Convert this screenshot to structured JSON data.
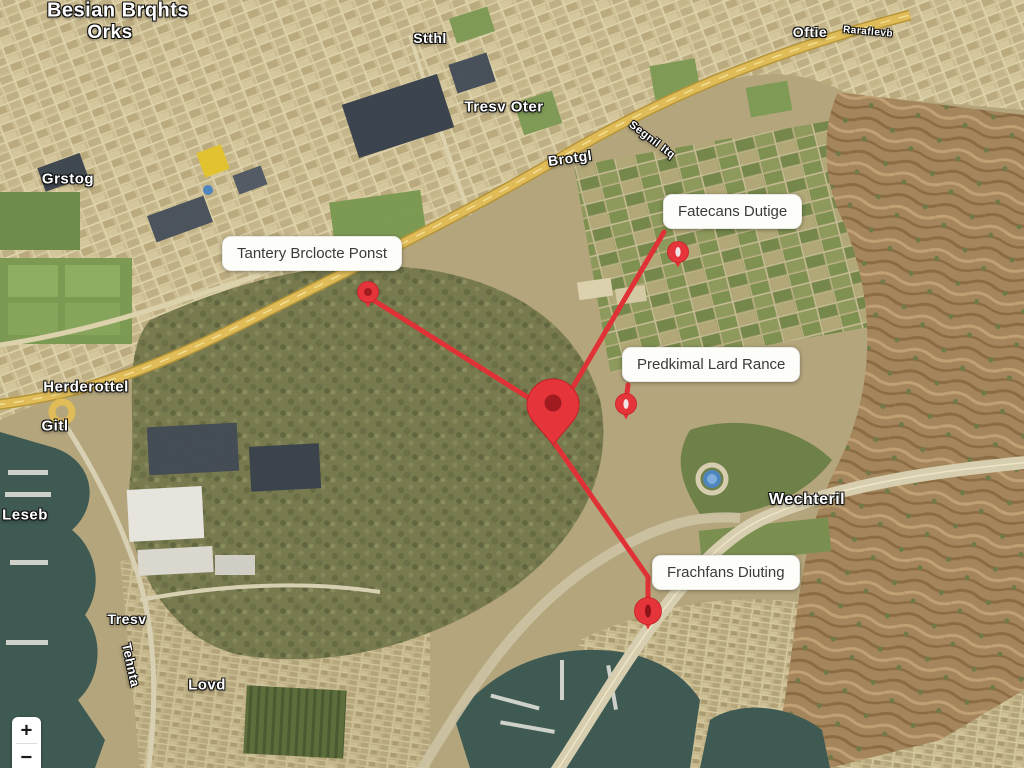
{
  "controls": {
    "zoom_in_label": "+",
    "zoom_out_label": "−"
  },
  "colors": {
    "route": "#e03236",
    "pin": "#e5343a",
    "pin_dark": "#a11b20",
    "pin_slot_light": "#f2e2e3",
    "pin_slot_dark": "#8c1418",
    "callout_bg": "#fdfdfa",
    "callout_text": "#3b3b3b",
    "highway_yellow": "#e2bd58",
    "water_teal": "#3d5952"
  },
  "callouts": [
    {
      "id": "callout-tantery",
      "text": "Tantery Brclocte Ponst",
      "x": 222,
      "y": 236
    },
    {
      "id": "callout-fatecans",
      "text": "Fatecans Dutige",
      "x": 663,
      "y": 194
    },
    {
      "id": "callout-predkimal",
      "text": "Predkimal Lard Rance",
      "x": 622,
      "y": 347
    },
    {
      "id": "callout-frachfans",
      "text": "Frachfans Diuting",
      "x": 652,
      "y": 555
    }
  ],
  "markers": [
    {
      "id": "map-pin-central",
      "style": "teardrop-large",
      "x": 553,
      "y": 445
    },
    {
      "id": "map-pin-tantery",
      "style": "dot",
      "x": 368,
      "y": 292
    },
    {
      "id": "map-pin-fatecans",
      "style": "slot",
      "x": 678,
      "y": 252
    },
    {
      "id": "map-pin-predkimal",
      "style": "slot",
      "x": 626,
      "y": 404
    },
    {
      "id": "map-pin-frachfans",
      "style": "slot-large",
      "x": 648,
      "y": 611
    }
  ],
  "routes": [
    {
      "id": "route-tantery-central",
      "points": [
        [
          370,
          298
        ],
        [
          548,
          410
        ]
      ]
    },
    {
      "id": "route-fatecans-central",
      "points": [
        [
          664,
          232
        ],
        [
          556,
          416
        ]
      ]
    },
    {
      "id": "route-predkimal-connector",
      "points": [
        [
          628,
          385
        ],
        [
          626,
          402
        ]
      ]
    },
    {
      "id": "route-central-frachfans",
      "points": [
        [
          553,
          441
        ],
        [
          648,
          577
        ],
        [
          648,
          598
        ]
      ]
    }
  ],
  "map_labels": [
    {
      "text": "Besian Brqhts",
      "x": 118,
      "y": 11,
      "size": 20,
      "rot": 0
    },
    {
      "text": "Orks",
      "x": 110,
      "y": 33,
      "size": 19,
      "rot": 0
    },
    {
      "text": "Stthl",
      "x": 430,
      "y": 38,
      "size": 14,
      "rot": 0
    },
    {
      "text": "Tresv Oter",
      "x": 504,
      "y": 107,
      "size": 15,
      "rot": 0
    },
    {
      "text": "Brotgl",
      "x": 570,
      "y": 158,
      "size": 14,
      "rot": -8
    },
    {
      "text": "Segnil Itq",
      "x": 652,
      "y": 140,
      "size": 11,
      "rot": 37
    },
    {
      "text": "Oftie",
      "x": 810,
      "y": 32,
      "size": 14,
      "rot": 0
    },
    {
      "text": "Raraflevb",
      "x": 868,
      "y": 32,
      "size": 10,
      "rot": 5
    },
    {
      "text": "Grstog",
      "x": 68,
      "y": 179,
      "size": 15,
      "rot": 0
    },
    {
      "text": "Herderottel",
      "x": 86,
      "y": 387,
      "size": 15,
      "rot": 0
    },
    {
      "text": "Gitl",
      "x": 55,
      "y": 426,
      "size": 15,
      "rot": 0
    },
    {
      "text": "Leseb",
      "x": 25,
      "y": 515,
      "size": 15,
      "rot": 0
    },
    {
      "text": "Tresv",
      "x": 127,
      "y": 619,
      "size": 14,
      "rot": 0
    },
    {
      "text": "Tehnta",
      "x": 131,
      "y": 665,
      "size": 13,
      "rot": 78
    },
    {
      "text": "Lovd",
      "x": 207,
      "y": 685,
      "size": 15,
      "rot": 0
    },
    {
      "text": "Wechteril",
      "x": 807,
      "y": 500,
      "size": 16,
      "rot": 0
    }
  ]
}
